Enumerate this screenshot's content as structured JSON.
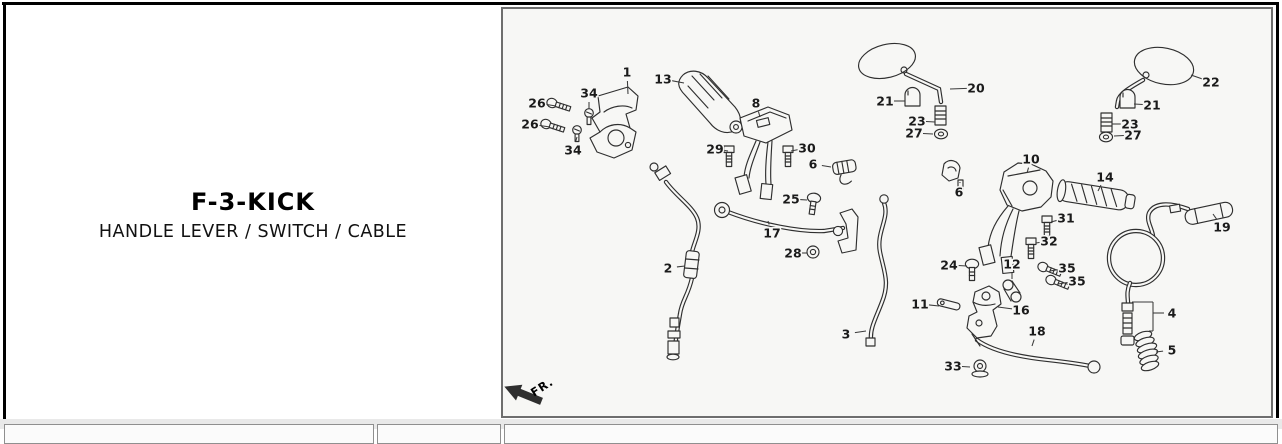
{
  "title_block": {
    "title": "F-3-KICK",
    "subtitle": "HANDLE LEVER / SWITCH / CABLE"
  },
  "diagram": {
    "fr_label": "FR.",
    "background": "#f7f7f5",
    "border_color": "#6e6e6e",
    "line_color": "#2f2f2f",
    "callouts": [
      {
        "label": "1",
        "lx": 627,
        "ly": 72,
        "tx": 628,
        "ty": 94
      },
      {
        "label": "13",
        "lx": 663,
        "ly": 79,
        "tx": 684,
        "ty": 83
      },
      {
        "label": "26",
        "lx": 537,
        "ly": 103,
        "tx": 556,
        "ty": 106
      },
      {
        "label": "34",
        "lx": 589,
        "ly": 93,
        "tx": 589,
        "ty": 109
      },
      {
        "label": "26",
        "lx": 530,
        "ly": 124,
        "tx": 550,
        "ty": 127
      },
      {
        "label": "34",
        "lx": 573,
        "ly": 150,
        "tx": 577,
        "ty": 137
      },
      {
        "label": "8",
        "lx": 756,
        "ly": 103,
        "tx": 760,
        "ty": 117
      },
      {
        "label": "29",
        "lx": 715,
        "ly": 149,
        "tx": 728,
        "ty": 151
      },
      {
        "label": "30",
        "lx": 807,
        "ly": 148,
        "tx": 791,
        "ty": 151
      },
      {
        "label": "6",
        "lx": 813,
        "ly": 164,
        "tx": 831,
        "ty": 167
      },
      {
        "label": "25",
        "lx": 791,
        "ly": 199,
        "tx": 807,
        "ty": 200
      },
      {
        "label": "17",
        "lx": 772,
        "ly": 233,
        "tx": 768,
        "ty": 221
      },
      {
        "label": "28",
        "lx": 793,
        "ly": 253,
        "tx": 807,
        "ty": 253
      },
      {
        "label": "2",
        "lx": 668,
        "ly": 268,
        "tx": 685,
        "ty": 266
      },
      {
        "label": "3",
        "lx": 846,
        "ly": 334,
        "tx": 866,
        "ty": 331
      },
      {
        "label": "20",
        "lx": 976,
        "ly": 88,
        "tx": 950,
        "ty": 89
      },
      {
        "label": "21",
        "lx": 885,
        "ly": 101,
        "tx": 905,
        "ty": 101
      },
      {
        "label": "23",
        "lx": 917,
        "ly": 121,
        "tx": 935,
        "ty": 122
      },
      {
        "label": "27",
        "lx": 914,
        "ly": 133,
        "tx": 933,
        "ty": 134
      },
      {
        "label": "22",
        "lx": 1211,
        "ly": 82,
        "tx": 1191,
        "ty": 75
      },
      {
        "label": "21",
        "lx": 1152,
        "ly": 105,
        "tx": 1134,
        "ty": 104
      },
      {
        "label": "23",
        "lx": 1130,
        "ly": 124,
        "tx": 1112,
        "ty": 124
      },
      {
        "label": "27",
        "lx": 1133,
        "ly": 135,
        "tx": 1114,
        "ty": 136
      },
      {
        "label": "10",
        "lx": 1031,
        "ly": 159,
        "tx": 1027,
        "ty": 173
      },
      {
        "label": "14",
        "lx": 1105,
        "ly": 177,
        "tx": 1098,
        "ty": 191
      },
      {
        "label": "6",
        "lx": 959,
        "ly": 192,
        "tx": 960,
        "ty": 182
      },
      {
        "label": "31",
        "lx": 1066,
        "ly": 218,
        "tx": 1051,
        "ty": 222
      },
      {
        "label": "32",
        "lx": 1049,
        "ly": 241,
        "tx": 1036,
        "ty": 243
      },
      {
        "label": "19",
        "lx": 1222,
        "ly": 227,
        "tx": 1213,
        "ty": 214
      },
      {
        "label": "24",
        "lx": 949,
        "ly": 265,
        "tx": 967,
        "ty": 266
      },
      {
        "label": "12",
        "lx": 1012,
        "ly": 264,
        "tx": 1012,
        "ty": 279
      },
      {
        "label": "35",
        "lx": 1067,
        "ly": 268,
        "tx": 1050,
        "ty": 271
      },
      {
        "label": "35",
        "lx": 1077,
        "ly": 281,
        "tx": 1058,
        "ty": 284
      },
      {
        "label": "11",
        "lx": 920,
        "ly": 304,
        "tx": 939,
        "ty": 306
      },
      {
        "label": "16",
        "lx": 1021,
        "ly": 310,
        "tx": 998,
        "ty": 307
      },
      {
        "label": "18",
        "lx": 1037,
        "ly": 331,
        "tx": 1032,
        "ty": 346
      },
      {
        "label": "33",
        "lx": 953,
        "ly": 366,
        "tx": 970,
        "ty": 367
      },
      {
        "label": "4",
        "lx": 1172,
        "ly": 313,
        "lines": [
          [
            1164,
            313,
            1153,
            313
          ],
          [
            1153,
            302,
            1153,
            331
          ],
          [
            1153,
            302,
            1132,
            302
          ],
          [
            1153,
            331,
            1149,
            331
          ]
        ]
      },
      {
        "label": "5",
        "lx": 1172,
        "ly": 350,
        "tx": 1156,
        "ty": 352
      }
    ]
  }
}
